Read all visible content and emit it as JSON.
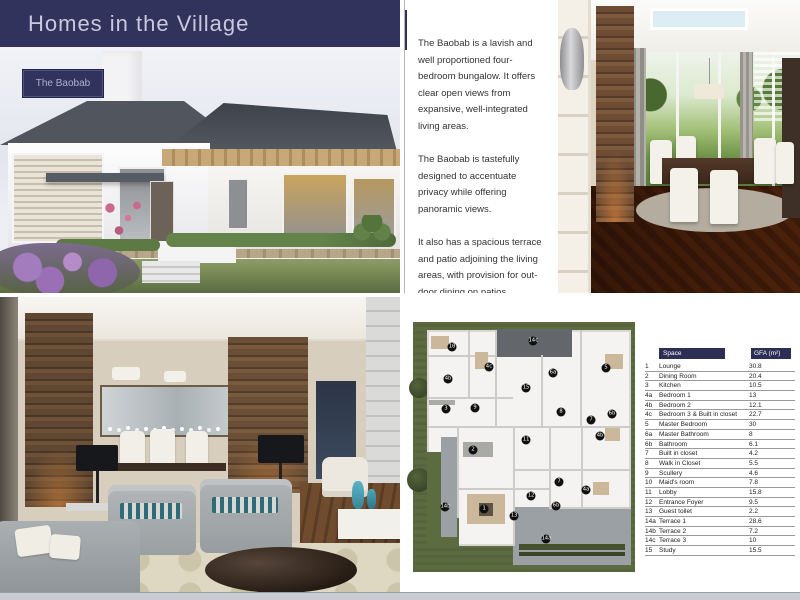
{
  "header": {
    "title": "Homes in the Village"
  },
  "badge": {
    "label": "The Baobab"
  },
  "description": {
    "paragraphs": [
      "The Baobab is a lavish and well proportioned four-bedroom bungalow. It offers clear open views from expansive, well-integrated living areas.",
      "The Baobab is tastefully designed to accentuate privacy while offering panoramic views.",
      "It also has a spacious terrace and patio adjoining the living areas, with provision for out-door dining on patios."
    ]
  },
  "floor_plan": {
    "markers": [
      {
        "label": "14c",
        "x": 120,
        "y": 19
      },
      {
        "label": "10",
        "x": 39,
        "y": 25
      },
      {
        "label": "4c",
        "x": 76,
        "y": 45
      },
      {
        "label": "4b",
        "x": 35,
        "y": 57
      },
      {
        "label": "6a",
        "x": 140,
        "y": 51
      },
      {
        "label": "15",
        "x": 113,
        "y": 66
      },
      {
        "label": "5",
        "x": 193,
        "y": 46
      },
      {
        "label": "3",
        "x": 33,
        "y": 87
      },
      {
        "label": "9",
        "x": 62,
        "y": 86
      },
      {
        "label": "8",
        "x": 148,
        "y": 90
      },
      {
        "label": "7",
        "x": 178,
        "y": 98
      },
      {
        "label": "6b",
        "x": 199,
        "y": 92
      },
      {
        "label": "11",
        "x": 113,
        "y": 118
      },
      {
        "label": "2",
        "x": 60,
        "y": 128
      },
      {
        "label": "4b",
        "x": 187,
        "y": 114
      },
      {
        "label": "7",
        "x": 146,
        "y": 160
      },
      {
        "label": "4a",
        "x": 173,
        "y": 168
      },
      {
        "label": "12",
        "x": 118,
        "y": 174
      },
      {
        "label": "6b",
        "x": 143,
        "y": 184
      },
      {
        "label": "14b",
        "x": 32,
        "y": 185
      },
      {
        "label": "1",
        "x": 71,
        "y": 187
      },
      {
        "label": "13",
        "x": 101,
        "y": 194
      },
      {
        "label": "14a",
        "x": 133,
        "y": 217
      }
    ]
  },
  "table": {
    "headers": {
      "space": "Space",
      "gfa": "GFA (m²)"
    },
    "rows": [
      {
        "no": "1",
        "space": "Lounge",
        "gfa": "30.8"
      },
      {
        "no": "2",
        "space": "Dining Room",
        "gfa": "20.4"
      },
      {
        "no": "3",
        "space": "Kitchen",
        "gfa": "10.5"
      },
      {
        "no": "4a",
        "space": "Bedroom 1",
        "gfa": "13"
      },
      {
        "no": "4b",
        "space": "Bedroom 2",
        "gfa": "12.1"
      },
      {
        "no": "4c",
        "space": "Bedroom 3 & Built in closet",
        "gfa": "22.7"
      },
      {
        "no": "5",
        "space": "Master Bedroom",
        "gfa": "30"
      },
      {
        "no": "6a",
        "space": "Master Bathroom",
        "gfa": "8"
      },
      {
        "no": "6b",
        "space": "Bathroom",
        "gfa": "6.1"
      },
      {
        "no": "7",
        "space": "Built in closet",
        "gfa": "4.2"
      },
      {
        "no": "8",
        "space": "Walk in Closet",
        "gfa": "5.5"
      },
      {
        "no": "9",
        "space": "Scullery",
        "gfa": "4.6"
      },
      {
        "no": "10",
        "space": "Maid's room",
        "gfa": "7.8"
      },
      {
        "no": "11",
        "space": "Lobby",
        "gfa": "15.8"
      },
      {
        "no": "12",
        "space": "Entrance Foyer",
        "gfa": "9.5"
      },
      {
        "no": "13",
        "space": "Guest toilet",
        "gfa": "2.2"
      },
      {
        "no": "14a",
        "space": "Terrace 1",
        "gfa": "28.6"
      },
      {
        "no": "14b",
        "space": "Terrace 2",
        "gfa": "7.2"
      },
      {
        "no": "14c",
        "space": "Terrace 3",
        "gfa": "10"
      },
      {
        "no": "15",
        "space": "Study",
        "gfa": "15.5"
      }
    ]
  },
  "colors": {
    "navy": "#32335c",
    "table_header_navy": "#2c2e55",
    "grass_green": "#5c6b40",
    "terrace_gray": "#9aa0a4",
    "roof_slate": "#4b4f57",
    "teal_accent": "#3c7f8e",
    "bottom_bar_gray": "#cbccd1"
  }
}
